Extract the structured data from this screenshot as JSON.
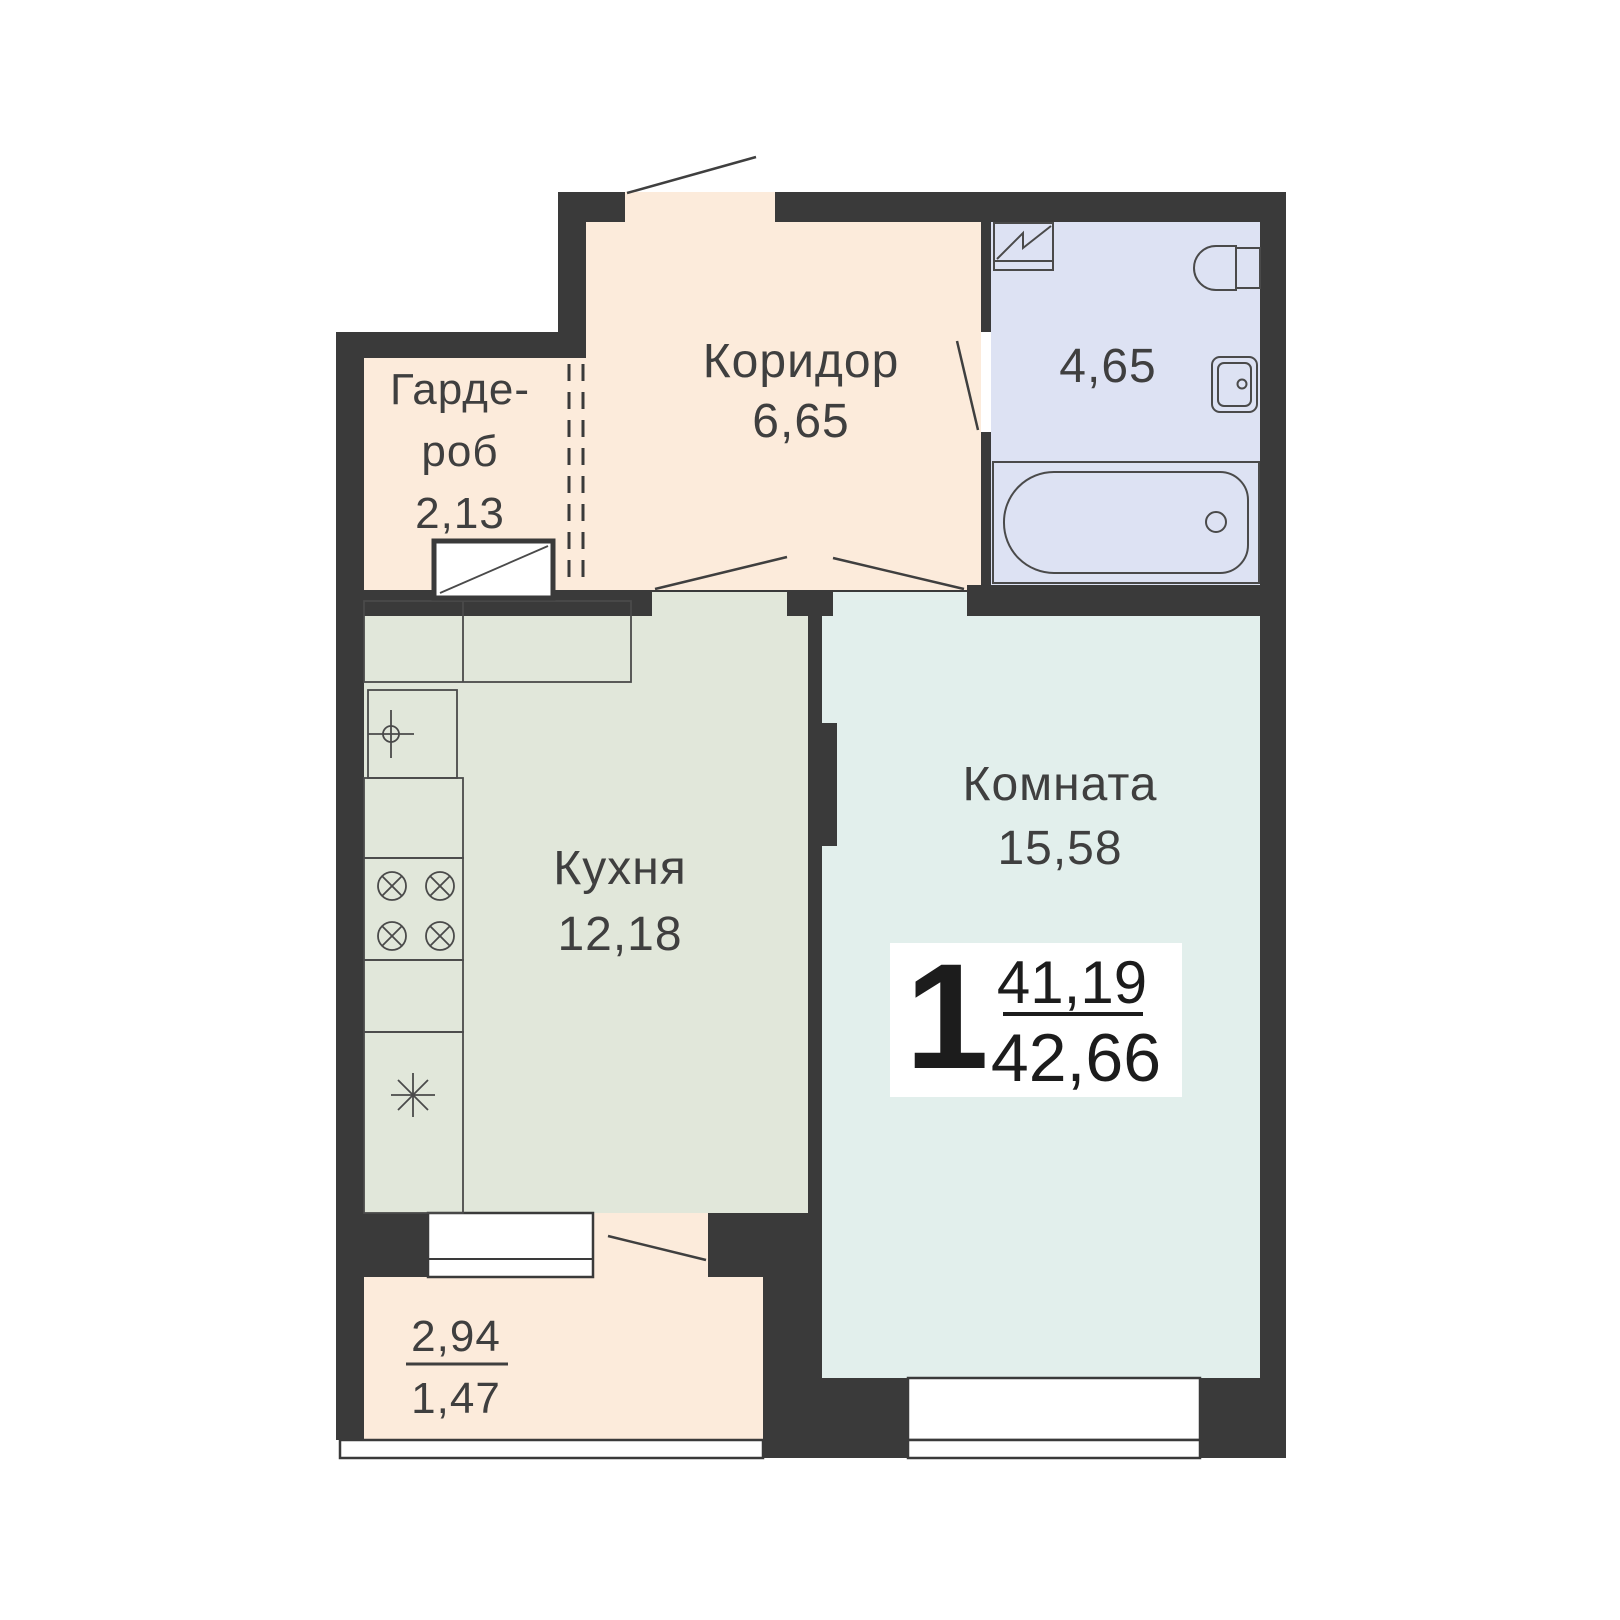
{
  "apartment": {
    "rooms_count": "1",
    "area_upper": "41,19",
    "area_lower": "42,66"
  },
  "rooms": {
    "corridor": {
      "name": "Коридор",
      "area": "6,65"
    },
    "wardrobe": {
      "name_line_1": "Гарде-",
      "name_line_2": "роб",
      "area": "2,13"
    },
    "bathroom": {
      "area": "4,65"
    },
    "kitchen": {
      "name": "Кухня",
      "area": "12,18"
    },
    "living_room": {
      "name": "Комната",
      "area": "15,58"
    },
    "balcony": {
      "area_full": "2,94",
      "area_reduced": "1,47"
    }
  },
  "fixtures": {
    "bathroom": [
      "washing-machine-icon",
      "toilet-icon",
      "washbasin-icon",
      "bathtub-icon"
    ],
    "kitchen": [
      "kitchen-sink-icon",
      "stove-icon",
      "fridge-icon",
      "counter"
    ],
    "wardrobe": [
      "cabinet-icon"
    ]
  },
  "colors": {
    "wall": "#3a3a3a",
    "hall": "#fcebdb",
    "bath": "#dde2f3",
    "kitchen": "#e1e7da",
    "room": "#e2efec",
    "ink": "#3f3f3f",
    "line": "#4a4a4a",
    "window": "#ffffff",
    "badge-bg": "#ffffff",
    "badge-ink": "#1c1c1c"
  }
}
